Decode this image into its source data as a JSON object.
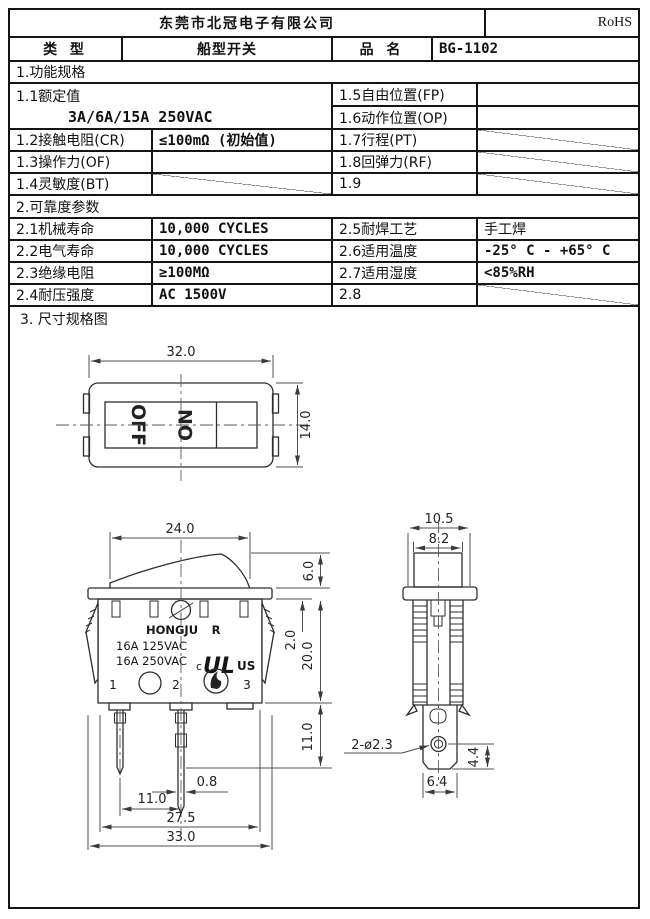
{
  "header": {
    "company": "东莞市北冠电子有限公司",
    "rohs": "RoHS",
    "type_label": "类 型",
    "type_value": "船型开关",
    "name_label": "品 名",
    "name_value": "BG-1102"
  },
  "section1": {
    "title": "1.功能规格",
    "r11_label": "1.1额定值",
    "r11_value": "3A/6A/15A  250VAC",
    "r15_label": "1.5自由位置(FP)",
    "r16_label": "1.6动作位置(OP)",
    "r12_label": "1.2接触电阻(CR)",
    "r12_value": "≤100mΩ (初始值)",
    "r17_label": "1.7行程(PT)",
    "r13_label": "1.3操作力(OF)",
    "r18_label": "1.8回弹力(RF)",
    "r14_label": "1.4灵敏度(BT)",
    "r19_label": "1.9"
  },
  "section2": {
    "title": "2.可靠度参数",
    "r21_label": "2.1机械寿命",
    "r21_value": "10,000  CYCLES",
    "r25_label": "2.5耐焊工艺",
    "r25_value": "手工焊",
    "r22_label": "2.2电气寿命",
    "r22_value": "10,000  CYCLES",
    "r26_label": "2.6适用温度",
    "r26_value": "-25° C - +65° C",
    "r23_label": "2.3绝缘电阻",
    "r23_value": "≥100MΩ",
    "r27_label": "2.7适用湿度",
    "r27_value": "<85%RH",
    "r24_label": "2.4耐压强度",
    "r24_value": "AC 1500V",
    "r28_label": "2.8"
  },
  "section3": {
    "title": "3. 尺寸规格图"
  },
  "drawing": {
    "top_view": {
      "dim_width": "32.0",
      "dim_height": "14.0",
      "off": "OFF",
      "on": "ON"
    },
    "front_view": {
      "dim_rocker_w": "24.0",
      "dim_rocker_h": "6.0",
      "dim_panel": "2.0",
      "dim_body_h": "20.0",
      "dim_term_len": "11.0",
      "dim_term_thk": "0.8",
      "dim_pitch": "11.0",
      "dim_snap_w": "27.5",
      "dim_total_w": "33.0",
      "brand": "HONGJU",
      "reg": "R",
      "rating1": "16A 125VAC",
      "rating2": "16A 250VAC",
      "ul_text": "UL",
      "ul_c": "c",
      "ul_us": "US",
      "pin1": "1",
      "pin2": "2",
      "pin3": "3"
    },
    "side_view": {
      "dim_total": "10.5",
      "dim_rocker": "8.2",
      "hole_note": "2-ø2.3",
      "dim_hole_pos": "4.4",
      "dim_term_w": "6.4"
    }
  }
}
